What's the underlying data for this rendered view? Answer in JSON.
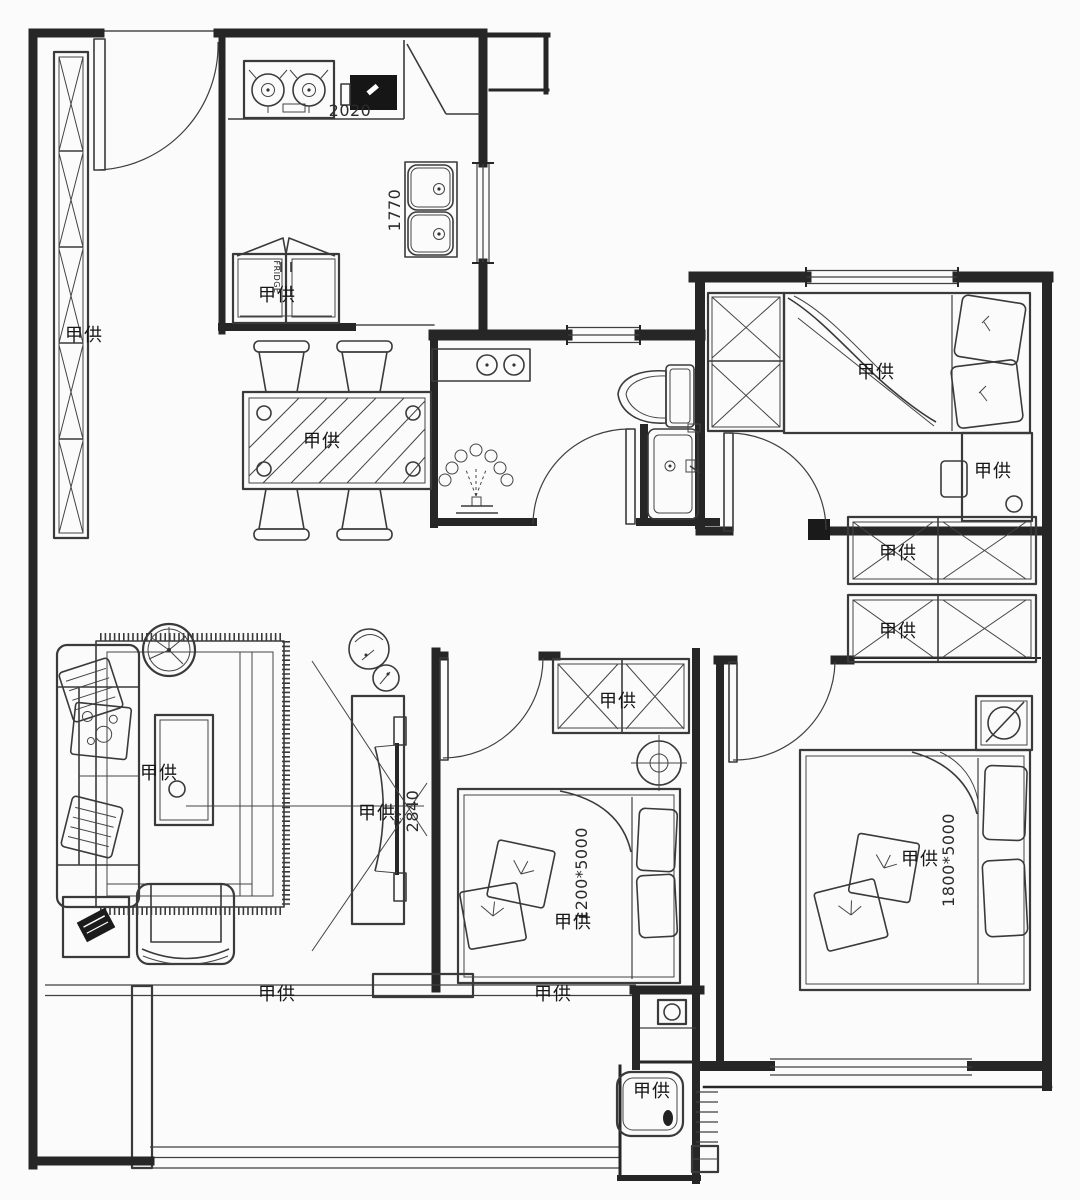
{
  "colors": {
    "background": "#fbfbfb",
    "wall_line": "#262626",
    "furniture_line": "#3a3a3a",
    "dark_fill": "#161616"
  },
  "labels": {
    "cabinet": "甲供",
    "fridge": "甲供",
    "fridge_tag": "FRIDGE",
    "dim_2020": "2020",
    "dim_1770": "1770",
    "dining": "甲供",
    "bed_top": "甲供",
    "desk": "甲供",
    "closet_row1": "甲供",
    "closet_row2": "甲供",
    "b2_wardrobe": "甲供",
    "b2_dim": "1200*5000",
    "b2_bed": "甲供",
    "master_bed": "甲供",
    "master_dim": "1800*5000",
    "tv": "甲供",
    "tv_tag": "T.V",
    "dim_2840": "2840",
    "coffee_table": "甲供",
    "balcony_left": "甲供",
    "balcony_right": "甲供",
    "tub": "甲供"
  }
}
